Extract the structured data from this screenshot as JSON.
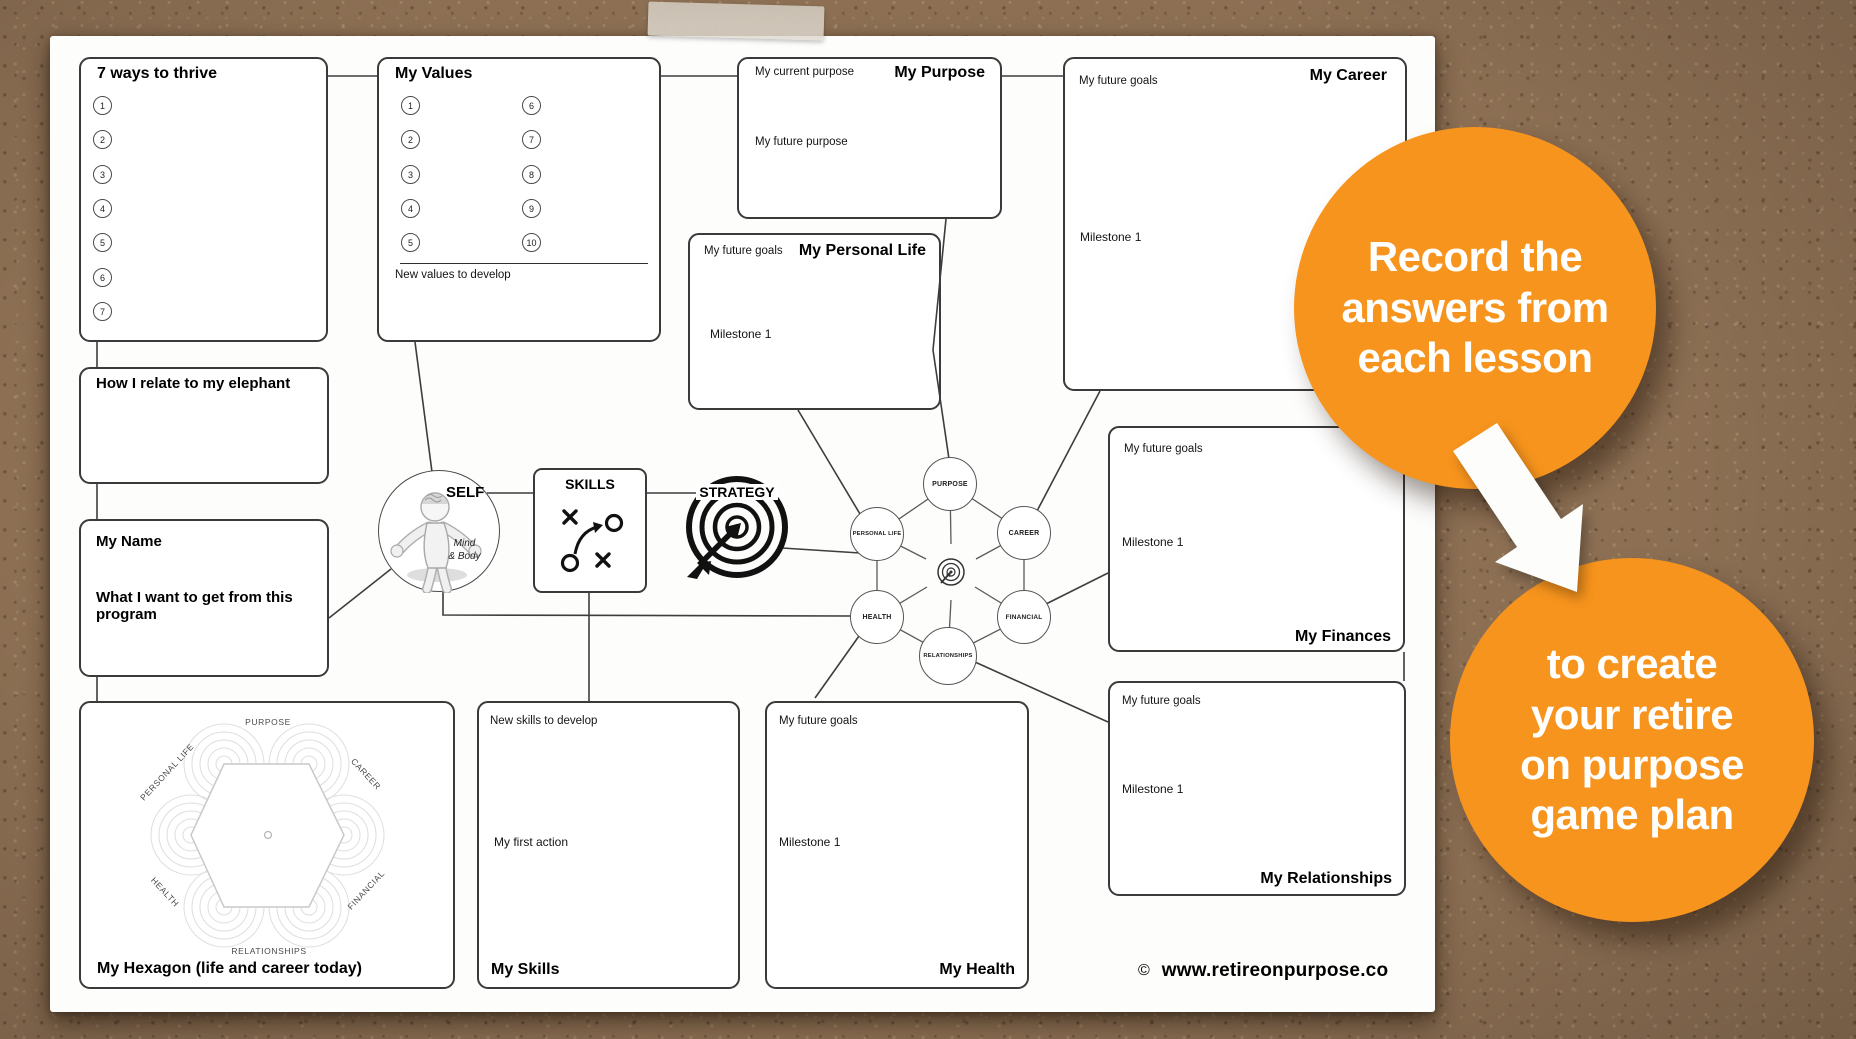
{
  "colors": {
    "orange": "#F7941D",
    "cork": "#8D7054",
    "paper": "#FDFDFC",
    "ink": "#111111",
    "line": "#3D3D3D"
  },
  "callouts": {
    "top_lines": [
      "Record the",
      "answers from",
      "each lesson"
    ],
    "bottom_lines": [
      "to create",
      "your retire",
      "on purpose",
      "game plan"
    ]
  },
  "footer": {
    "copyright": "©",
    "website": "www.retireonpurpose.co"
  },
  "boxes": {
    "seven_ways": {
      "title": "7 ways to thrive",
      "numbers": [
        "1",
        "2",
        "3",
        "4",
        "5",
        "6",
        "7"
      ]
    },
    "values": {
      "title": "My Values",
      "numbers_left": [
        "1",
        "2",
        "3",
        "4",
        "5"
      ],
      "numbers_right": [
        "6",
        "7",
        "8",
        "9",
        "10"
      ],
      "footer_label": "New values to develop"
    },
    "elephant": {
      "title": "How I relate to my elephant"
    },
    "name": {
      "title": "My Name",
      "prompt": "What I want to get from this program"
    },
    "purpose": {
      "title": "My Purpose",
      "current_label": "My current purpose",
      "future_label": "My future purpose"
    },
    "personal_life": {
      "title": "My Personal Life",
      "goals_label": "My future goals",
      "milestone_label": "Milestone 1"
    },
    "career": {
      "title": "My Career",
      "goals_label": "My future goals",
      "milestone_label": "Milestone 1"
    },
    "finances": {
      "title": "My Finances",
      "goals_label": "My future goals",
      "milestone_label": "Milestone 1"
    },
    "relationships": {
      "title": "My Relationships",
      "goals_label": "My future goals",
      "milestone_label": "Milestone 1"
    },
    "skills": {
      "title": "My Skills",
      "develop_label": "New skills to develop",
      "action_label": "My first action"
    },
    "health": {
      "title": "My Health",
      "goals_label": "My future goals",
      "milestone_label": "Milestone 1"
    },
    "hexagon": {
      "title": "My Hexagon (life and career today)",
      "axes": [
        "PURPOSE",
        "PERSONAL LIFE",
        "CAREER",
        "HEALTH",
        "FINANCIAL",
        "RELATIONSHIPS"
      ]
    }
  },
  "hub": {
    "self": "SELF",
    "self_sub_1": "Mind",
    "self_sub_2": "& Body",
    "skills": "SKILLS",
    "strategy": "STRATEGY"
  },
  "network": {
    "nodes": [
      "PURPOSE",
      "PERSONAL LIFE",
      "CAREER",
      "HEALTH",
      "FINANCIAL",
      "RELATIONSHIPS"
    ]
  }
}
